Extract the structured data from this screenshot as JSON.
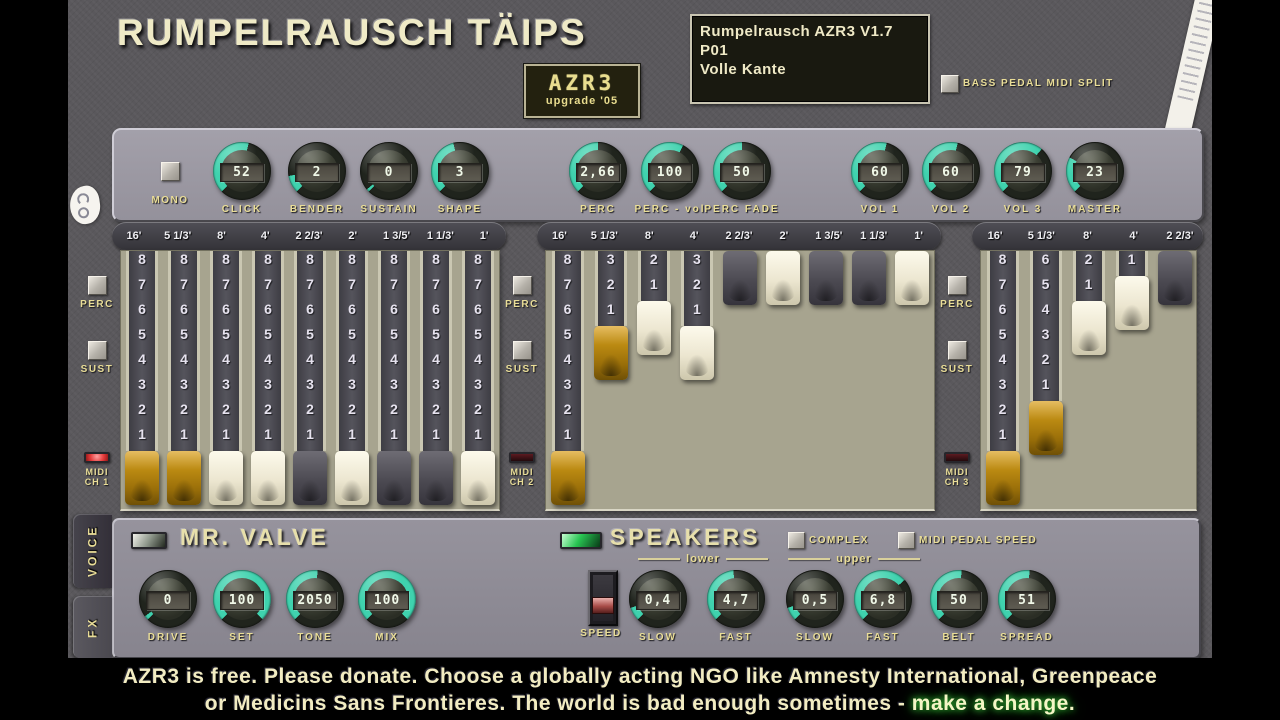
{
  "header": {
    "title": "RUMPELRAUSCH TÄIPS",
    "badge_line1": "AZR3",
    "badge_line2": "upgrade '05"
  },
  "lcd": {
    "line1": "Rumpelrausch AZR3 V1.7  P01",
    "line2": "Volle Kante"
  },
  "bass_split_label": "BASS PEDAL MIDI SPLIT",
  "top_controls": {
    "mono_label": "MONO",
    "knobs": [
      {
        "label": "CLICK",
        "value": "52",
        "arc": 0.55
      },
      {
        "label": "BENDER",
        "value": "2",
        "arc": 0.13
      },
      {
        "label": "SUSTAIN",
        "value": "0",
        "arc": 0.02
      },
      {
        "label": "SHAPE",
        "value": "3",
        "arc": 0.45
      },
      {
        "label": "PERC",
        "value": "2,66",
        "arc": 0.5
      },
      {
        "label": "PERC - vol",
        "value": "100",
        "arc": 0.6
      },
      {
        "label": "PERC FADE",
        "value": "50",
        "arc": 0.5
      },
      {
        "label": "VOL 1",
        "value": "60",
        "arc": 0.55
      },
      {
        "label": "VOL 2",
        "value": "60",
        "arc": 0.55
      },
      {
        "label": "VOL 3",
        "value": "79",
        "arc": 0.65
      },
      {
        "label": "MASTER",
        "value": "23",
        "arc": 0.27
      }
    ]
  },
  "drawbar_sections": [
    {
      "name": "manual-1",
      "perc_label": "PERC",
      "sust_label": "SUST",
      "midi_line1": "MIDI",
      "midi_line2": "CH 1",
      "led_on": true,
      "drawbars": [
        {
          "label": "16'",
          "value": 8,
          "color": "gold"
        },
        {
          "label": "5 1/3'",
          "value": 8,
          "color": "gold"
        },
        {
          "label": "8'",
          "value": 8,
          "color": "white"
        },
        {
          "label": "4'",
          "value": 8,
          "color": "white"
        },
        {
          "label": "2 2/3'",
          "value": 8,
          "color": "black"
        },
        {
          "label": "2'",
          "value": 8,
          "color": "white"
        },
        {
          "label": "1 3/5'",
          "value": 8,
          "color": "black"
        },
        {
          "label": "1 1/3'",
          "value": 8,
          "color": "black"
        },
        {
          "label": "1'",
          "value": 8,
          "color": "white"
        }
      ]
    },
    {
      "name": "manual-2",
      "perc_label": "PERC",
      "sust_label": "SUST",
      "midi_line1": "MIDI",
      "midi_line2": "CH 2",
      "led_on": false,
      "drawbars": [
        {
          "label": "16'",
          "value": 8,
          "color": "gold"
        },
        {
          "label": "5 1/3'",
          "value": 3,
          "color": "gold"
        },
        {
          "label": "8'",
          "value": 2,
          "color": "white"
        },
        {
          "label": "4'",
          "value": 3,
          "color": "white"
        },
        {
          "label": "2 2/3'",
          "value": 0,
          "color": "black"
        },
        {
          "label": "2'",
          "value": 0,
          "color": "white"
        },
        {
          "label": "1 3/5'",
          "value": 0,
          "color": "black"
        },
        {
          "label": "1 1/3'",
          "value": 0,
          "color": "black"
        },
        {
          "label": "1'",
          "value": 0,
          "color": "white"
        }
      ]
    },
    {
      "name": "pedal",
      "perc_label": "PERC",
      "sust_label": "SUST",
      "midi_line1": "MIDI",
      "midi_line2": "CH 3",
      "led_on": false,
      "drawbars": [
        {
          "label": "16'",
          "value": 8,
          "color": "gold"
        },
        {
          "label": "5 1/3'",
          "value": 6,
          "color": "gold"
        },
        {
          "label": "8'",
          "value": 2,
          "color": "white"
        },
        {
          "label": "4'",
          "value": 1,
          "color": "white"
        },
        {
          "label": "2 2/3'",
          "value": 0,
          "color": "black"
        }
      ]
    }
  ],
  "valve": {
    "title": "MR. VALVE",
    "knobs": [
      {
        "label": "DRIVE",
        "value": "0",
        "arc": 0.03
      },
      {
        "label": "SET",
        "value": "100",
        "arc": 1.0
      },
      {
        "label": "TONE",
        "value": "2050",
        "arc": 0.52
      },
      {
        "label": "MIX",
        "value": "100",
        "arc": 1.0
      }
    ]
  },
  "speakers": {
    "title": "SPEAKERS",
    "complex_label": "COMPLEX",
    "midi_pedal_label": "MIDI PEDAL SPEED",
    "lower_label": "lower",
    "upper_label": "upper",
    "speed_label": "SPEED",
    "knobs": [
      {
        "label": "SLOW",
        "value": "0,4",
        "arc": 0.1
      },
      {
        "label": "FAST",
        "value": "4,7",
        "arc": 0.48
      },
      {
        "label": "SLOW",
        "value": "0,5",
        "arc": 0.1
      },
      {
        "label": "FAST",
        "value": "6,8",
        "arc": 0.68
      },
      {
        "label": "BELT",
        "value": "50",
        "arc": 0.52
      },
      {
        "label": "SPREAD",
        "value": "51",
        "arc": 0.52
      }
    ]
  },
  "tabs": {
    "voice": "VOICE",
    "fx": "FX"
  },
  "footer": {
    "line1": "AZR3 is free. Please donate. Choose a globally acting NGO like Amnesty International, Greenpeace",
    "line2_prefix": "or Medicins Sans Frontieres. The world is bad enough sometimes - ",
    "line2_highlight": "make a change."
  },
  "colors": {
    "accent_teal": "#3fd2ae",
    "ring_off": "#20241d",
    "led_red": "#e63c3c",
    "led_green": "#28c452",
    "cream_label": "#e9dd97",
    "handle_gold": "#bb8a12",
    "drawbar_body": "#a7a48f"
  }
}
